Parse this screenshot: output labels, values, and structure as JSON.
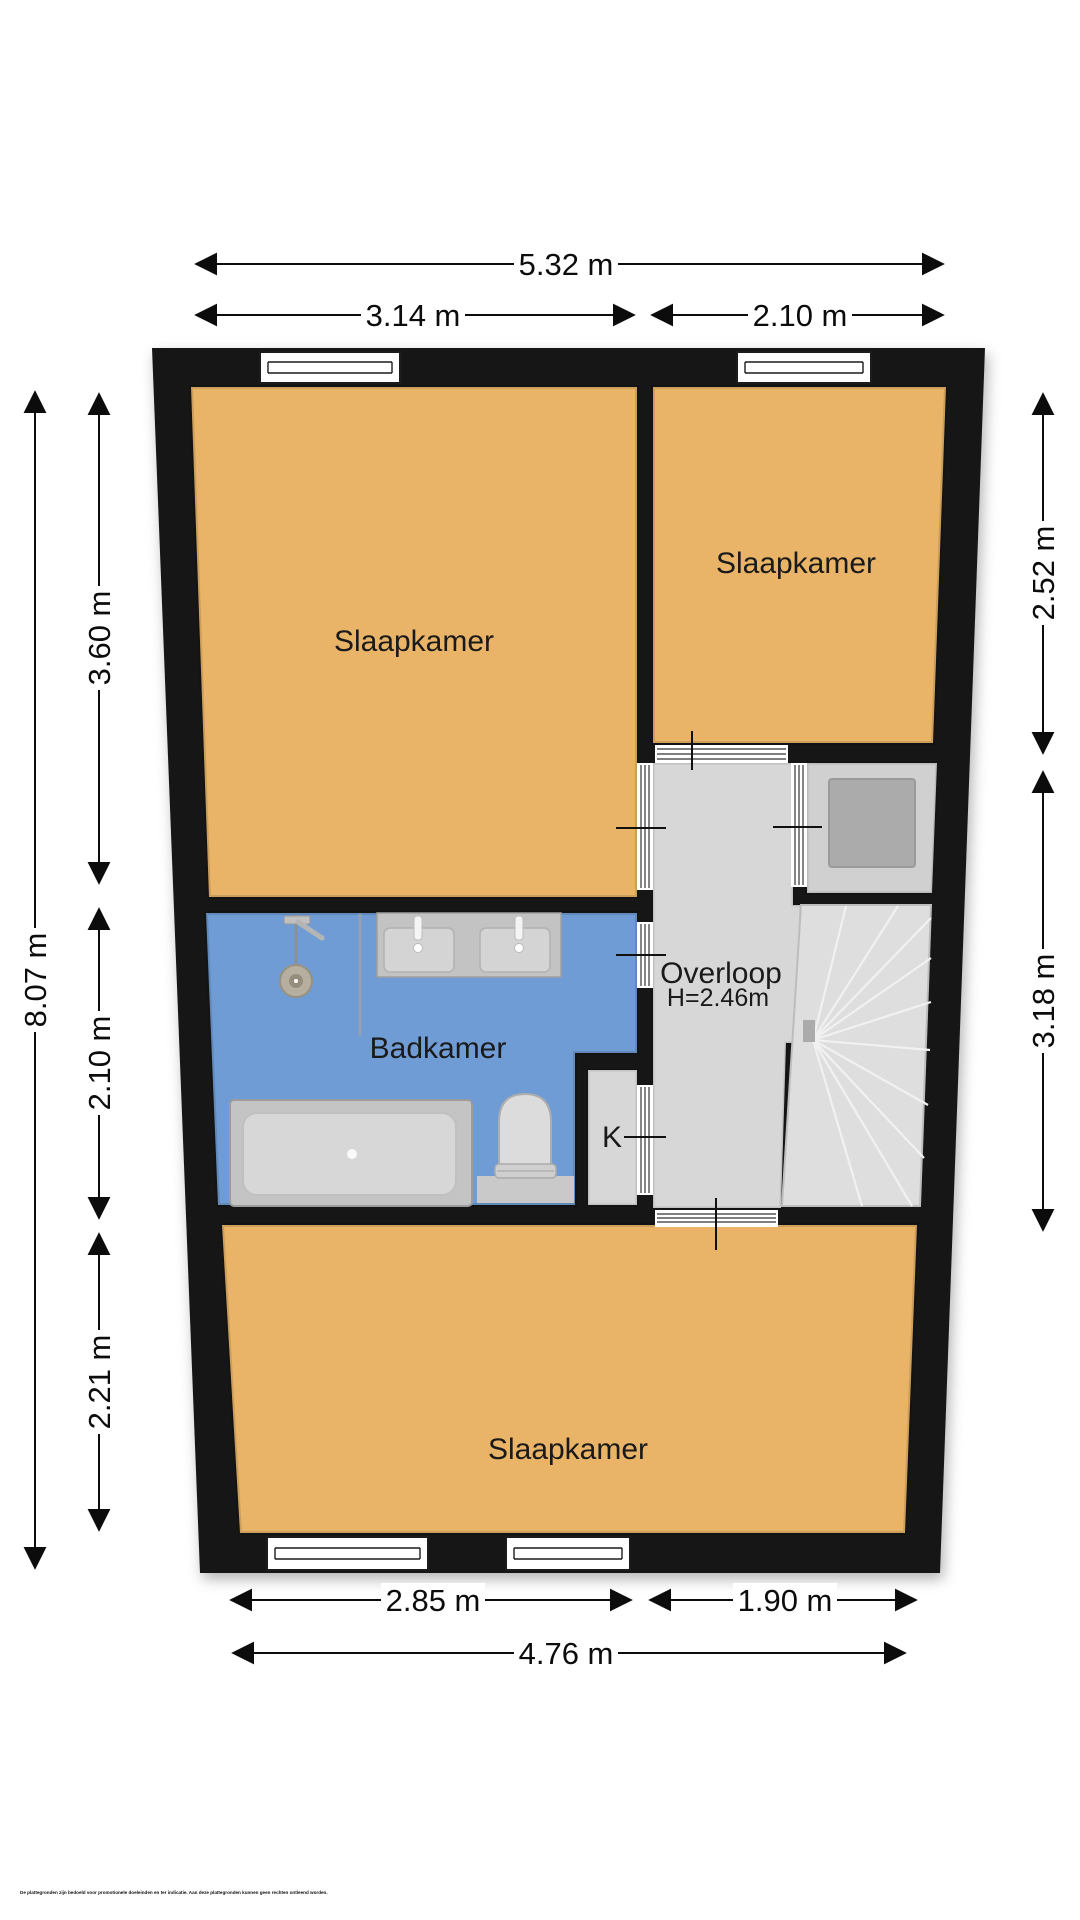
{
  "floor_plan": {
    "rooms": [
      {
        "id": "slaapkamer-top-left",
        "label": "Slaapkamer"
      },
      {
        "id": "slaapkamer-top-right",
        "label": "Slaapkamer"
      },
      {
        "id": "badkamer",
        "label": "Badkamer"
      },
      {
        "id": "overloop",
        "label": "Overloop",
        "height_label": "H=2.46m"
      },
      {
        "id": "kast",
        "label": "K"
      },
      {
        "id": "slaapkamer-bottom",
        "label": "Slaapkamer"
      }
    ],
    "dimensions": {
      "top": [
        {
          "id": "total-width",
          "label": "5.32 m"
        },
        {
          "id": "left-width",
          "label": "3.14 m"
        },
        {
          "id": "right-width",
          "label": "2.10 m"
        }
      ],
      "bottom": [
        {
          "id": "bottom-left-width",
          "label": "2.85 m"
        },
        {
          "id": "bottom-right-width",
          "label": "1.90 m"
        },
        {
          "id": "bottom-total-width",
          "label": "4.76 m"
        }
      ],
      "left": [
        {
          "id": "total-height",
          "label": "8.07 m"
        },
        {
          "id": "top-section-height",
          "label": "3.60 m"
        },
        {
          "id": "mid-section-height",
          "label": "2.10 m"
        },
        {
          "id": "low-section-height",
          "label": "2.21 m"
        }
      ],
      "right": [
        {
          "id": "bedroom-height",
          "label": "2.52 m"
        },
        {
          "id": "landing-height",
          "label": "3.18 m"
        }
      ]
    },
    "colors": {
      "wall": "#171717",
      "bedroom": "#e9b468",
      "bathroom": "#6f9cd4",
      "landing": "#d7d7d7",
      "closet_floor": "#d0d0d0",
      "stairs": "#dedede"
    },
    "disclaimer": "De plattegronden zijn bedoeld voor promotionele doeleinden en ter indicatie. Aan deze plattegronden kunnen geen rechten ontleend worden."
  }
}
